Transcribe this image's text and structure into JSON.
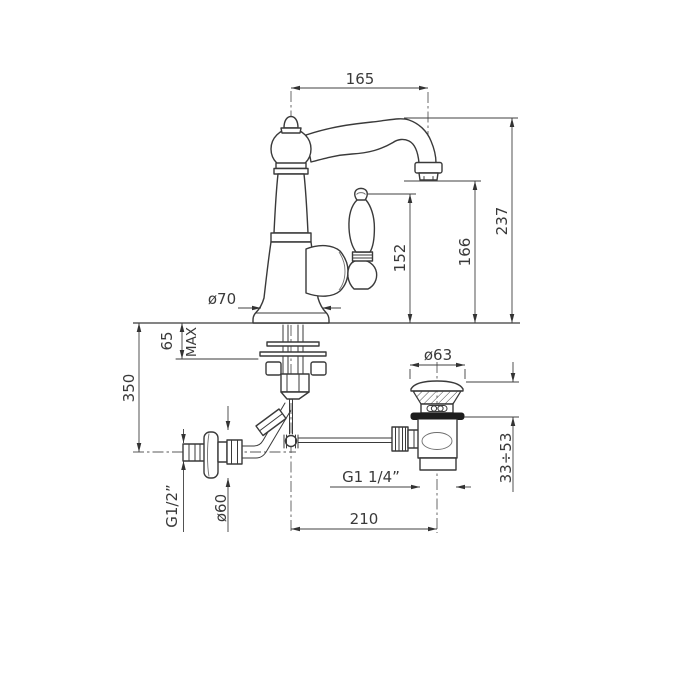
{
  "meta": {
    "title": "Single-hole basin mixer with pop-up waste - dimensional technical drawing",
    "background": "#ffffff",
    "line_color": "#3a3a3a",
    "dimension_color": "#404040"
  },
  "labels": {
    "spout_reach": "165",
    "overall_height": "237",
    "spout_outlet_height": "166",
    "handle_height": "152",
    "body_base_diameter": "ø70",
    "max_deck_thickness_value": "65",
    "max_deck_thickness_qualifier": "MAX",
    "supply_below_deck_length": "350",
    "supply_thread_size": "G1/2”",
    "wall_flange_diameter": "ø60",
    "waste_plug_diameter": "ø63",
    "waste_adjustment_range": "33÷53",
    "waste_thread_size": "G1 1/4”",
    "spout_to_waste_distance": "210"
  }
}
